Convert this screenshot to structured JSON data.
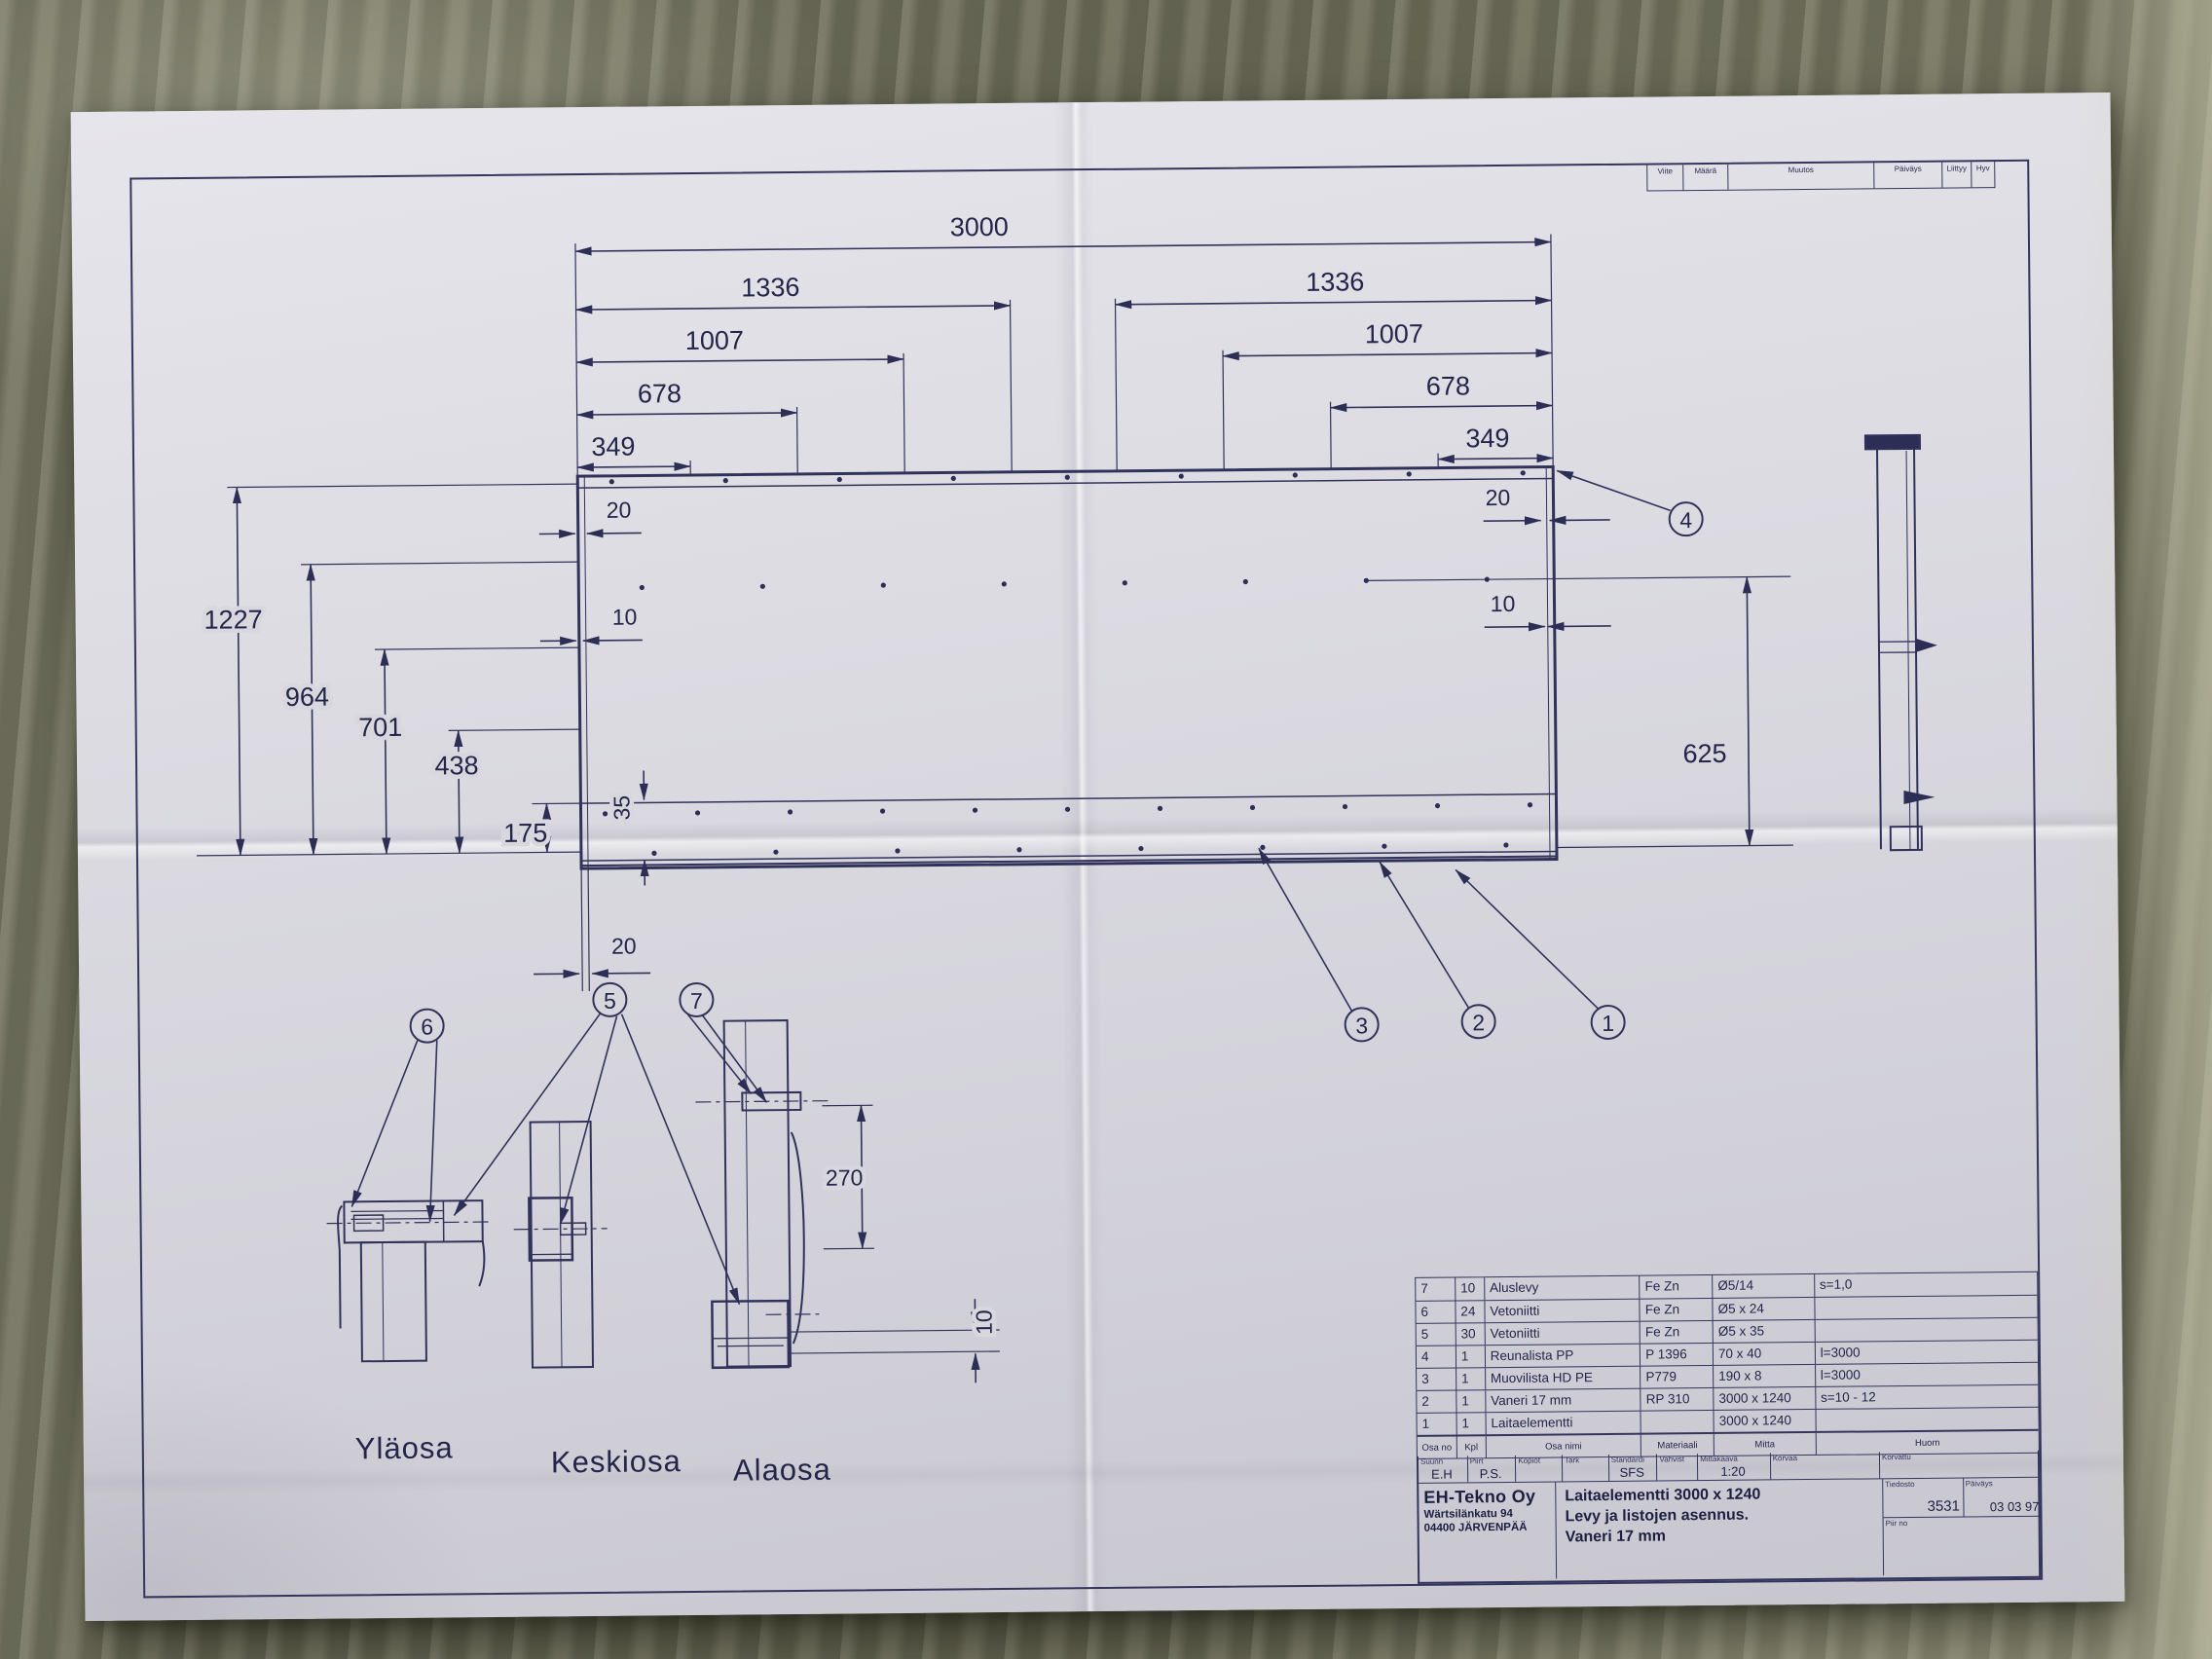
{
  "colors": {
    "ink": "#2c2e55",
    "paper": "#d9d8df",
    "floor_dark": "#5f5e4f",
    "floor_light": "#8a8a76"
  },
  "revision_table": {
    "headers": [
      "Viite",
      "Määrä",
      "Muutos",
      "Päiväys",
      "Liittyy",
      "Hyv"
    ]
  },
  "drawing": {
    "dims": {
      "len_total": "3000",
      "len_1336": "1336",
      "len_1007": "1007",
      "len_678": "678",
      "len_349": "349",
      "h_1227": "1227",
      "h_964": "964",
      "h_701": "701",
      "h_438": "438",
      "h_175": "175",
      "off_20": "20",
      "off_10": "10",
      "h_625": "625",
      "off_35": "35",
      "off_270": "270",
      "bot_20": "20",
      "bot_10": "10"
    },
    "callouts": {
      "c1": "1",
      "c2": "2",
      "c3": "3",
      "c4": "4",
      "c5": "5",
      "c6": "6",
      "c7": "7"
    },
    "section_labels": {
      "top": "Yläosa",
      "middle": "Keskiosa",
      "bottom": "Alaosa"
    }
  },
  "parts_table": {
    "headers": [
      "Osa no",
      "Kpl",
      "Osa nimi",
      "Materiaali",
      "Mitta",
      "Huom"
    ],
    "rows": [
      {
        "no": "7",
        "kpl": "10",
        "name": "Aluslevy",
        "material": "Fe Zn",
        "size": "Ø5/14",
        "note": "s=1,0"
      },
      {
        "no": "6",
        "kpl": "24",
        "name": "Vetoniitti",
        "material": "Fe Zn",
        "size": "Ø5 x 24",
        "note": ""
      },
      {
        "no": "5",
        "kpl": "30",
        "name": "Vetoniitti",
        "material": "Fe Zn",
        "size": "Ø5 x 35",
        "note": ""
      },
      {
        "no": "4",
        "kpl": "1",
        "name": "Reunalista PP",
        "material": "P 1396",
        "size": "70 x 40",
        "note": "l=3000"
      },
      {
        "no": "3",
        "kpl": "1",
        "name": "Muovilista HD PE",
        "material": "P779",
        "size": "190 x 8",
        "note": "l=3000"
      },
      {
        "no": "2",
        "kpl": "1",
        "name": "Vaneri 17 mm",
        "material": "RP 310",
        "size": "3000 x 1240",
        "note": "s=10 - 12"
      },
      {
        "no": "1",
        "kpl": "1",
        "name": "Laitaelementti",
        "material": "",
        "size": "3000 x 1240",
        "note": ""
      }
    ]
  },
  "title_block": {
    "fields": {
      "suunn": "Suunn",
      "piirt": "Piirt",
      "kopiot": "Kopiot",
      "tark": "Tark",
      "standardi": "Standardi",
      "vahvist": "Vahvist",
      "mittakaava": "Mittakaava",
      "korvaa": "Korvaa",
      "korvattu": "Korvattu",
      "tiedosto": "Tiedosto",
      "paivays": "Päiväys",
      "piir_no": "Piir no"
    },
    "values": {
      "suunn": "E.H",
      "piirt": "P.S.",
      "standardi": "SFS",
      "mittakaava": "1:20",
      "tiedosto": "3531",
      "paivays": "03 03 97"
    },
    "company": {
      "name": "EH-Tekno Oy",
      "address_line1": "Wärtsilänkatu 94",
      "address_line2": "04400 JÄRVENPÄÄ"
    },
    "title_lines": [
      "Laitaelementti 3000 x 1240",
      "Levy ja listojen asennus.",
      "Vaneri 17 mm"
    ]
  }
}
